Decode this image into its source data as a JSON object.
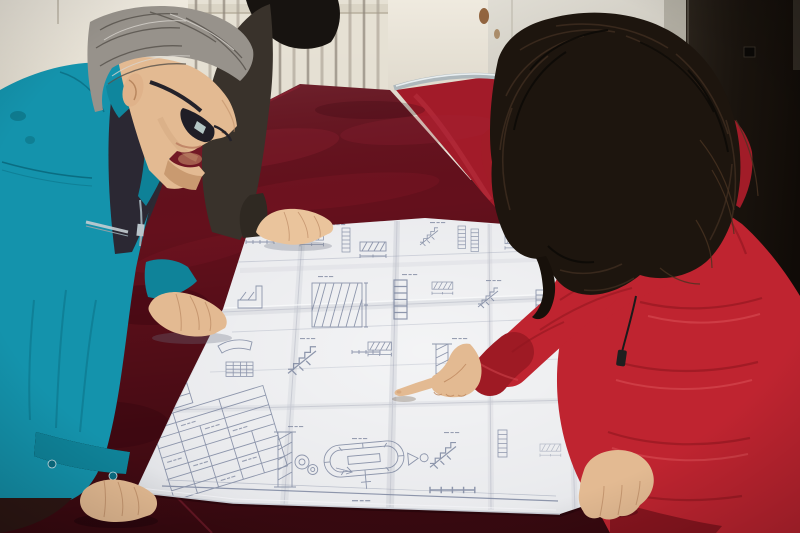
{
  "scene": {
    "description": "Two workers lean over a large folded engineering blueprint spread on a dark crimson velvet-covered table; a man in a teal work jacket and glasses studies the sheet while a woman in a red down coat with an orange fur-trimmed hood points at a detail with her index finger.",
    "setting": "Indoor room with a cream radiator wall, a light door frame and a dark door on the right."
  },
  "people": {
    "man_left": {
      "description": "Middle-aged man, gray hair, dark-rimmed glasses, teal work jacket, both hands resting on the blueprint"
    },
    "person_back": {
      "description": "Partially visible person in a dark jacket with black hair, one hand resting on the top edge of the blueprint"
    },
    "woman_right": {
      "description": "Woman with long dark wavy hair in a red hooded down coat with orange fur trim, pointing at the drawing"
    }
  },
  "objects": {
    "blueprint": {
      "description": "Large white folded construction drawing sheet with stair sections, hatched details, dimension chains, a stadium-shaped detail and a title block table"
    },
    "table": {
      "description": "Table draped in dark crimson velvet"
    },
    "chair": {
      "description": "Metal-framed chair with red upholstered back behind the table"
    },
    "radiator": {
      "description": "Cream wall radiator with vertical fins"
    },
    "doors": {
      "description": "Light door frame and near-black door on the right wall"
    }
  },
  "palette": {
    "wall_cream": "#e9e4d9",
    "door_dark": "#1b1510",
    "chair_red": "#a21b29",
    "velvet_base": "#64101c",
    "velvet_dark": "#3f0911",
    "paper": "#e8e9ec",
    "drawing_line": "#7d87a0",
    "hair_gray": "#97928b",
    "hair_dark": "#1d150e",
    "skin": "#e3ba92",
    "jacket_teal": "#1493ac",
    "inner_shirt": "#2c2933",
    "dark_jacket": "#39322b",
    "coat_red": "#bf2430",
    "coat_red_dark": "#a11c28",
    "fur_base": "#6e4314",
    "fur_orange": "#d98c2e"
  }
}
